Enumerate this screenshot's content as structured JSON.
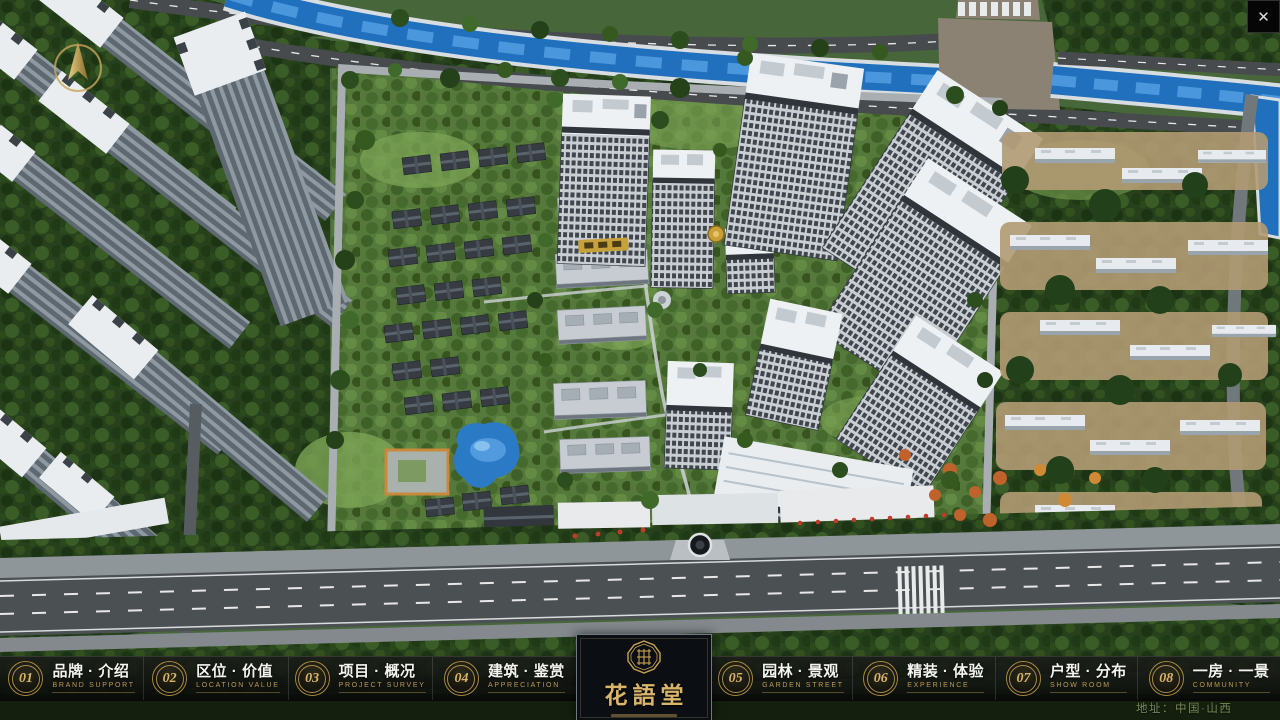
{
  "window": {
    "close_icon": "✕"
  },
  "nav": {
    "left_items": [
      {
        "num": "01",
        "zh": "品牌 · 介绍",
        "en": "BRAND SUPPORT"
      },
      {
        "num": "02",
        "zh": "区位 · 价值",
        "en": "LOCATION VALUE"
      },
      {
        "num": "03",
        "zh": "项目 · 概况",
        "en": "PROJECT SURVEY"
      },
      {
        "num": "04",
        "zh": "建筑 · 鉴赏",
        "en": "APPRECIATION"
      }
    ],
    "right_items": [
      {
        "num": "05",
        "zh": "园林 · 景观",
        "en": "GARDEN STREET"
      },
      {
        "num": "06",
        "zh": "精装 · 体验",
        "en": "EXPERIENCE"
      },
      {
        "num": "07",
        "zh": "户型 · 分布",
        "en": "SHOW ROOM"
      },
      {
        "num": "08",
        "zh": "一房 · 一景",
        "en": "COMMUNITY"
      }
    ]
  },
  "logo": {
    "name": "花語堂"
  },
  "footer": {
    "address": "地址：中国·山西"
  },
  "colors": {
    "gold": "#c9a45a",
    "river_blue": "#2170bd",
    "nav_background": "#0b0e12"
  }
}
